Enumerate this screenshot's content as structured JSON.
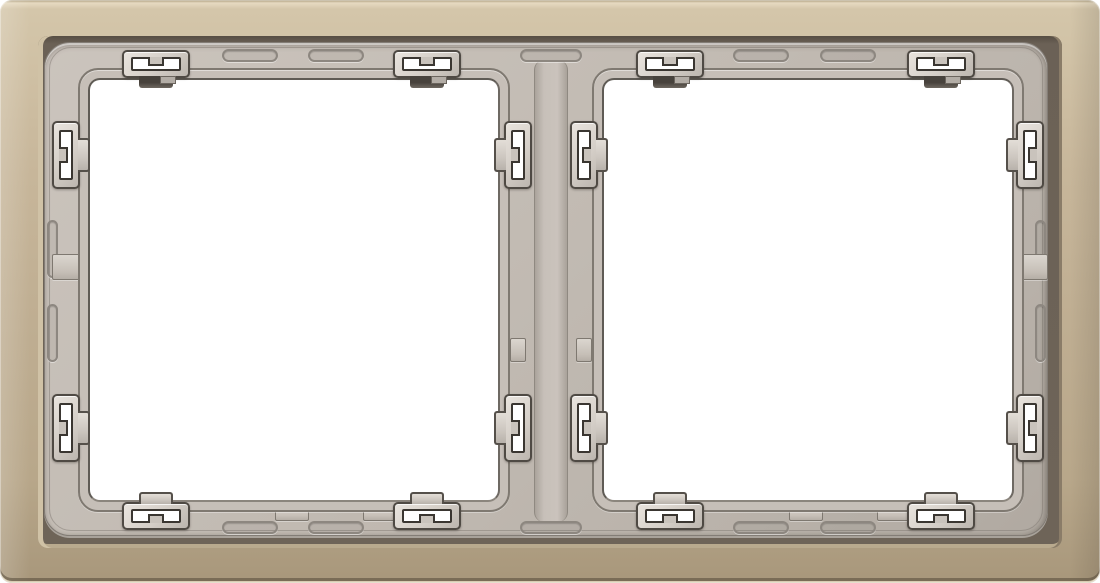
{
  "scene": {
    "type": "product-photo",
    "subject": "Two-gang wall switch cover frame, metallic champagne finish, grey plastic carrier with spring mounting clips, two empty square windows",
    "background_color": "#ffffff"
  },
  "colors": {
    "metal_face": "#bfae92",
    "metal_highlight": "#e6dac1",
    "metal_shadow_edge": "#8a7c68",
    "cut_shadow": "#6b6156",
    "carrier_grey": "#c2bbb3",
    "carrier_line": "#837d76",
    "clip_face": "#d4cec7",
    "clip_outline": "#4f4a44",
    "slot_white": "#ffffff",
    "foot_dark": "#47423c",
    "window_white": "#ffffff"
  },
  "canvas": {
    "w": 1100,
    "h": 583
  },
  "metal": {
    "radius": 12
  },
  "cut": {
    "x": 38,
    "y": 36,
    "w": 1024,
    "h": 512
  },
  "carrier": {
    "x": 44,
    "y": 42,
    "w": 1004,
    "h": 494,
    "contour_inset": 5
  },
  "divider_strip": {
    "x": 534,
    "y": 60,
    "w": 34,
    "h": 462
  },
  "windows": [
    {
      "id": "window-left",
      "x": 88,
      "y": 78,
      "w": 412,
      "h": 424
    },
    {
      "id": "window-right",
      "x": 602,
      "y": 78,
      "w": 412,
      "h": 424
    }
  ],
  "lip_offset": 10,
  "clip_metrics": {
    "h_body": {
      "w": 68,
      "h": 28
    },
    "v_body": {
      "w": 28,
      "h": 68
    },
    "top_body_y": 50,
    "bottom_body_y": 502,
    "foot_len": 34,
    "foot_depth": 12,
    "slot_inset_h": {
      "x": 7,
      "y": 5
    },
    "slot_inset_v": {
      "x": 5,
      "y": 7
    },
    "bar": {
      "w": 16,
      "h": 9
    }
  },
  "clips": [
    {
      "type": "h",
      "cx": 156,
      "edge": "top"
    },
    {
      "type": "h",
      "cx": 427,
      "edge": "top"
    },
    {
      "type": "h",
      "cx": 670,
      "edge": "top"
    },
    {
      "type": "h",
      "cx": 941,
      "edge": "top"
    },
    {
      "type": "h",
      "cx": 156,
      "edge": "bottom"
    },
    {
      "type": "h",
      "cx": 427,
      "edge": "bottom"
    },
    {
      "type": "h",
      "cx": 670,
      "edge": "bottom"
    },
    {
      "type": "h",
      "cx": 941,
      "edge": "bottom"
    },
    {
      "type": "v",
      "x": 52,
      "cy": 155,
      "half": "left",
      "foot": "right"
    },
    {
      "type": "v",
      "x": 52,
      "cy": 428,
      "half": "left",
      "foot": "right"
    },
    {
      "type": "v",
      "x": 504,
      "cy": 155,
      "half": "left",
      "foot": "left"
    },
    {
      "type": "v",
      "x": 504,
      "cy": 428,
      "half": "left",
      "foot": "left"
    },
    {
      "type": "v",
      "x": 570,
      "cy": 155,
      "half": "right",
      "foot": "right"
    },
    {
      "type": "v",
      "x": 570,
      "cy": 428,
      "half": "right",
      "foot": "right"
    },
    {
      "type": "v",
      "x": 1016,
      "cy": 155,
      "half": "right",
      "foot": "left"
    },
    {
      "type": "v",
      "x": 1016,
      "cy": 428,
      "half": "right",
      "foot": "left"
    }
  ],
  "grooves": {
    "top_y": 49,
    "bottom_y": 521,
    "h": 13,
    "horizontal_segments": [
      {
        "x": 222,
        "w": 56
      },
      {
        "x": 308,
        "w": 56
      },
      {
        "x": 520,
        "w": 62
      },
      {
        "x": 733,
        "w": 56
      },
      {
        "x": 820,
        "w": 56
      }
    ],
    "side_x_left": 47,
    "side_x_right": 1035,
    "side_w": 11,
    "side_segments": [
      {
        "y": 220,
        "h": 58
      },
      {
        "y": 304,
        "h": 58
      }
    ]
  },
  "notches": [
    {
      "x": 275,
      "y": 505,
      "w": 34,
      "h": 16
    },
    {
      "x": 363,
      "y": 505,
      "w": 34,
      "h": 16
    },
    {
      "x": 789,
      "y": 505,
      "w": 34,
      "h": 16
    },
    {
      "x": 877,
      "y": 505,
      "w": 34,
      "h": 16
    },
    {
      "x": 510,
      "y": 338,
      "w": 16,
      "h": 24
    },
    {
      "x": 576,
      "y": 338,
      "w": 16,
      "h": 24
    },
    {
      "x": 52,
      "y": 254,
      "w": 34,
      "h": 26
    },
    {
      "x": 1016,
      "y": 254,
      "w": 32,
      "h": 26
    }
  ]
}
